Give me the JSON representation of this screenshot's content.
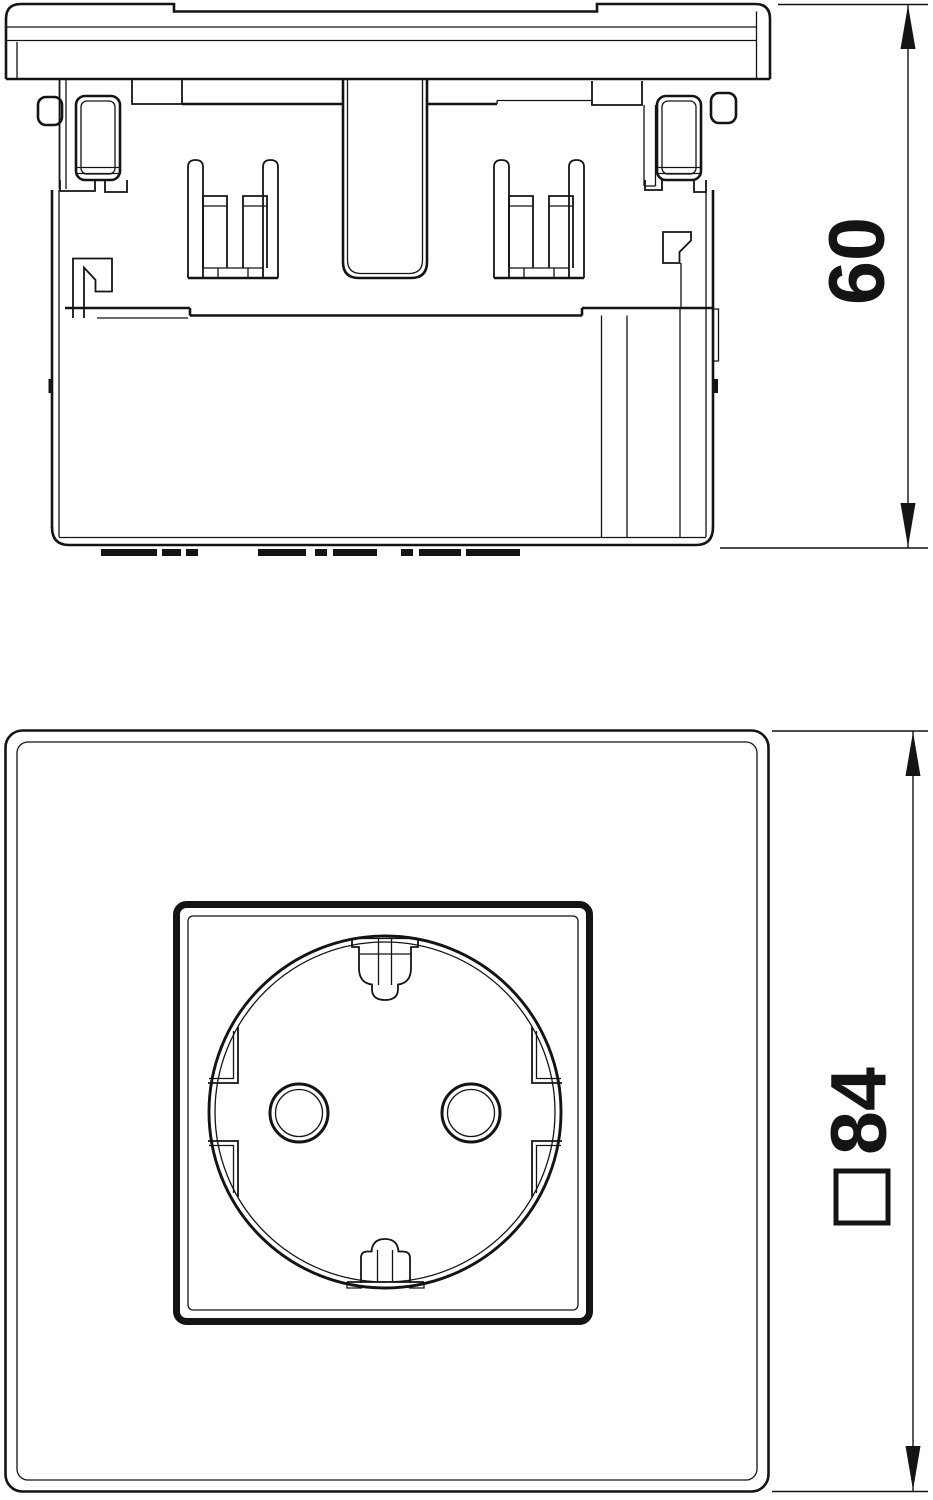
{
  "page": {
    "background": "#ffffff",
    "line_color": "#141414",
    "kind": "technical dimensional drawing, socket insert"
  },
  "views": {
    "side": {
      "name": "side profile view",
      "dimension_value": "60",
      "dimension_orientation": "vertical"
    },
    "front": {
      "name": "front view",
      "dimension_value": "84",
      "dimension_prefix_icon": "white-square-symbol",
      "dimension_orientation": "vertical"
    }
  }
}
